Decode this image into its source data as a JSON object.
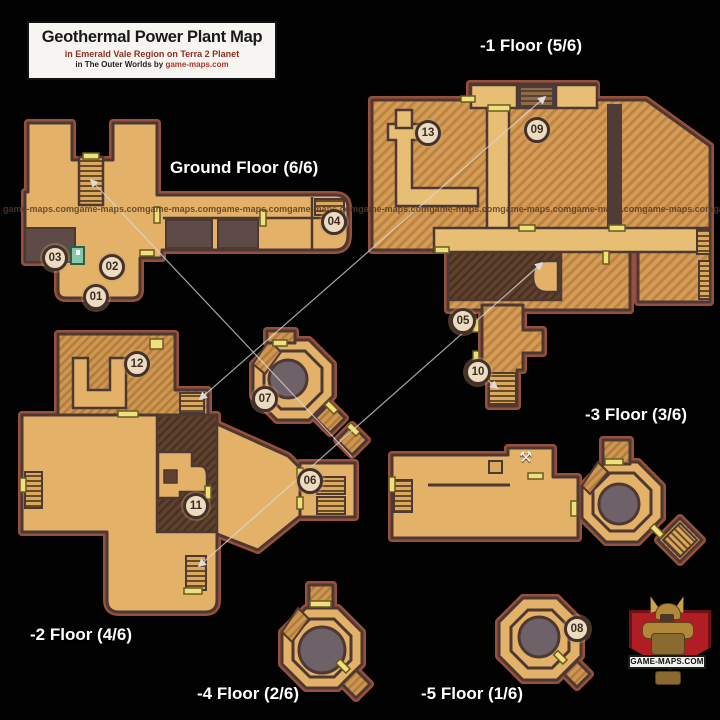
{
  "title_box": {
    "title": "Geothermal Power Plant Map",
    "subtitle": "in Emerald Vale Region on Terra 2 Planet",
    "credit_prefix": "in The Outer Worlds by ",
    "credit_link": "game-maps.com"
  },
  "floors": [
    {
      "id": "ground",
      "label": "Ground Floor (6/6)"
    },
    {
      "id": "minus1",
      "label": "-1 Floor (5/6)"
    },
    {
      "id": "minus2",
      "label": "-2 Floor (4/6)"
    },
    {
      "id": "minus3",
      "label": "-3 Floor (3/6)"
    },
    {
      "id": "minus4",
      "label": "-4 Floor (2/6)"
    },
    {
      "id": "minus5",
      "label": "-5 Floor (1/6)"
    }
  ],
  "markers": [
    {
      "label": "01"
    },
    {
      "label": "02"
    },
    {
      "label": "03"
    },
    {
      "label": "04"
    },
    {
      "label": "05"
    },
    {
      "label": "06"
    },
    {
      "label": "07"
    },
    {
      "label": "08"
    },
    {
      "label": "09"
    },
    {
      "label": "10"
    },
    {
      "label": "11"
    },
    {
      "label": "12"
    },
    {
      "label": "13"
    }
  ],
  "watermark": "game-maps.com",
  "logo": {
    "banner": "GAME-MAPS.COM"
  },
  "icons": {
    "workbench": "⚒"
  },
  "colors": {
    "background": "#020202",
    "map_fill": "#e3b268",
    "map_outline": "#4e3833",
    "map_outer_rim": "#99503a",
    "dark_room": "#5e4a47",
    "wood_hatch": "#d49c54",
    "reactor_circle": "#6e6167",
    "door_marker": "#efe07c",
    "marker_fill": "#ebdcc0",
    "marker_ring": "#45302b",
    "label_text": "#ffffff",
    "logo_red": "#b01d24"
  }
}
